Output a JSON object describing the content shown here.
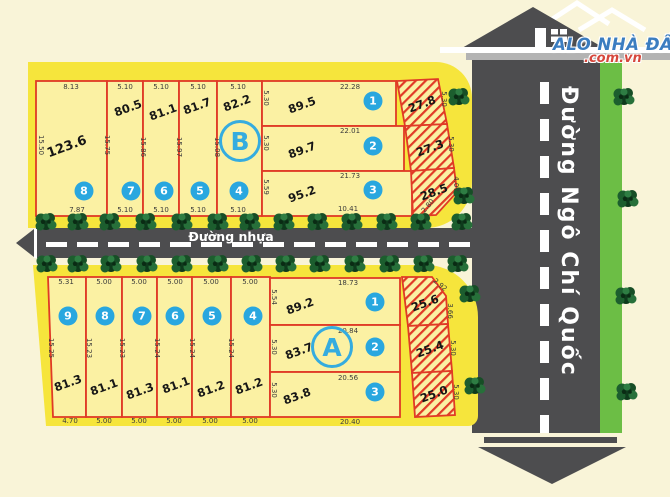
{
  "logo": {
    "title": "ALO NHÀ ĐẤT",
    "domain": ".com.vn"
  },
  "roads": {
    "horizontal_name": "Đường nhựa",
    "vertical_name": "Đường Ngô Chí Quốc"
  },
  "colors": {
    "background_cream": "#F9F4D8",
    "block_yellow": "#F6E53C",
    "plot_yellow": "#FBF1A3",
    "boundary_red": "#E03A26",
    "road_gray": "#4D4D4F",
    "green_strip": "#6CBE45",
    "circle_blue": "#29A7DF",
    "logo_blue": "#3B7DC0",
    "logo_red": "#D6473C"
  },
  "block_b": {
    "label": "B",
    "strip_plots": [
      {
        "num": "8",
        "area": "123.6",
        "top": "8.13",
        "bottom": "7.87"
      },
      {
        "num": "7",
        "area": "80.5",
        "top": "5.10",
        "bottom": "5.10"
      },
      {
        "num": "6",
        "area": "81.1",
        "top": "5.10",
        "bottom": "5.10"
      },
      {
        "num": "5",
        "area": "81.7",
        "top": "5.10",
        "bottom": "5.10"
      },
      {
        "num": "4",
        "area": "82.2",
        "top": "5.10",
        "bottom": "5.10"
      }
    ],
    "side_labels": [
      "15.50",
      "15.75",
      "15.86",
      "15.97",
      "15.08"
    ],
    "row_plots": [
      {
        "num": "1",
        "area": "89.5",
        "top": "22.28",
        "left": "5.30"
      },
      {
        "num": "2",
        "area": "89.7",
        "top": "22.01",
        "left": "5.30"
      },
      {
        "num": "3",
        "area": "95.2",
        "top": "21.73",
        "left": "5.59",
        "bottom": "10.41"
      }
    ],
    "hatched": [
      {
        "area": "27.8",
        "right": "5.30"
      },
      {
        "area": "27.3",
        "right": "5.30"
      },
      {
        "area": "28.5",
        "right": "4.07",
        "diag": "2.80"
      }
    ]
  },
  "block_a": {
    "label": "A",
    "strip_plots": [
      {
        "num": "9",
        "area": "81.3",
        "top": "5.31",
        "bottom": "4.70"
      },
      {
        "num": "8",
        "area": "81.1",
        "top": "5.00",
        "bottom": "5.00"
      },
      {
        "num": "7",
        "area": "81.3",
        "top": "5.00",
        "bottom": "5.00"
      },
      {
        "num": "6",
        "area": "81.1",
        "top": "5.00",
        "bottom": "5.00"
      },
      {
        "num": "5",
        "area": "81.2",
        "top": "5.00",
        "bottom": "5.00"
      },
      {
        "num": "4",
        "area": "81.2",
        "top": "5.00",
        "bottom": "5.00"
      }
    ],
    "side_labels": [
      "15.25",
      "15.23",
      "15.23",
      "15.24",
      "15.24",
      "15.24"
    ],
    "row_plots": [
      {
        "num": "1",
        "area": "89.2",
        "top": "18.73",
        "left": "5.54"
      },
      {
        "num": "2",
        "area": "83.7",
        "top": "20.84",
        "left": "5.30"
      },
      {
        "num": "3",
        "area": "83.8",
        "top": "20.56",
        "left": "5.30",
        "bottom": "20.40"
      }
    ],
    "hatched": [
      {
        "area": "25.6",
        "right": "3.66",
        "diag": "2.92"
      },
      {
        "area": "25.4",
        "right": "5.30"
      },
      {
        "area": "25.0",
        "right": "5.30"
      }
    ]
  }
}
